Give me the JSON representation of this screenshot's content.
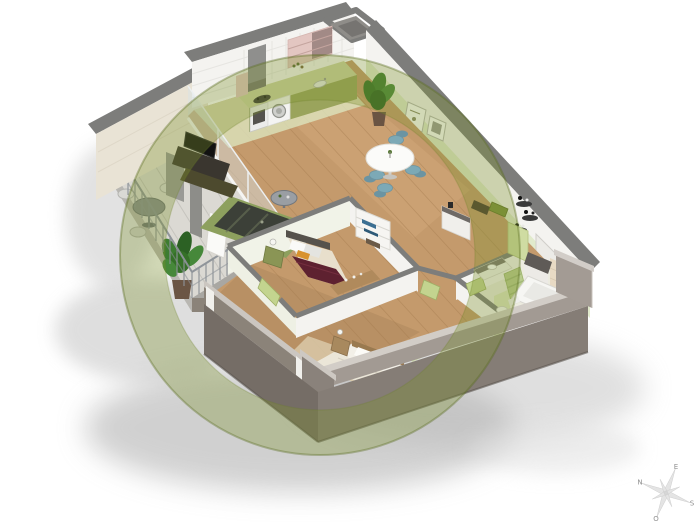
{
  "compass": {
    "points": [
      {
        "id": "north",
        "label": "N"
      },
      {
        "id": "east",
        "label": "E"
      },
      {
        "id": "south",
        "label": "S"
      },
      {
        "id": "west",
        "label": "O"
      }
    ]
  },
  "watermark": {
    "shape": "ring",
    "color": "#7f942f"
  },
  "scene": {
    "rooms": [
      "balcony",
      "kitchen",
      "living-dining",
      "hall",
      "bedroom-1",
      "bedroom-2",
      "bathroom"
    ]
  },
  "colors": {
    "wall-top": "#7d7d7b",
    "wall-white": "#f4f3f0",
    "accent-green": "#dfe9c8",
    "exterior-cream": "#e9e3d5",
    "exterior-near": "#a29a93",
    "exterior-near-dark": "#8b8379",
    "slab": "#857d76",
    "slab-dark": "#756d66",
    "floor-wood": "#c49a6c",
    "plank-line": "#a57c50",
    "bath-floor": "#ecebdf",
    "balcony-floor": "#dbd9d3",
    "railing": "#8c9298",
    "counter": "#ccd29e",
    "cabinet-olive": "#9aa45c",
    "pink": "#e3c6c1",
    "chair-teal": "#7ca9b6",
    "rug-border": "#8da05e",
    "rug": "#3c4038",
    "bed-burgundy": "#5e2130",
    "bed-white": "#f3f0e8",
    "wood-furniture": "#b08a5c",
    "door-green": "#c3d48f",
    "radiator-green": "#b9cc8e",
    "plant-green": "#3d7c31",
    "watermark": "#7f942f",
    "compass": "#e4e4e4",
    "compass-text": "#8f8f8f"
  }
}
